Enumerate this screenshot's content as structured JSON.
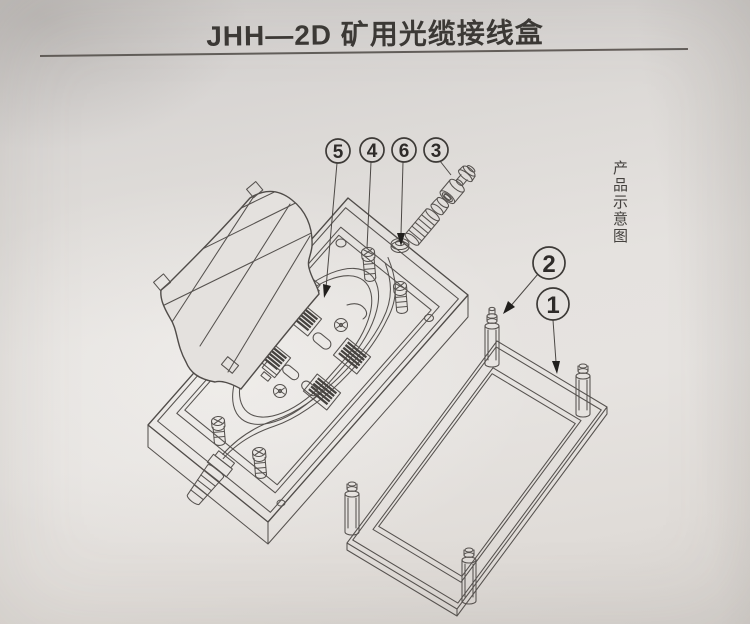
{
  "page": {
    "title": "JHH—2D 矿用光缆接线盒",
    "side_caption": "产品示意图"
  },
  "callouts": [
    {
      "label": "5"
    },
    {
      "label": "4"
    },
    {
      "label": "6"
    },
    {
      "label": "3"
    },
    {
      "label": "2"
    },
    {
      "label": "1"
    }
  ],
  "colors": {
    "paper": "#e4e1de",
    "ink": "#56524f",
    "text": "#3b3835",
    "arrow": "#211f1d"
  }
}
